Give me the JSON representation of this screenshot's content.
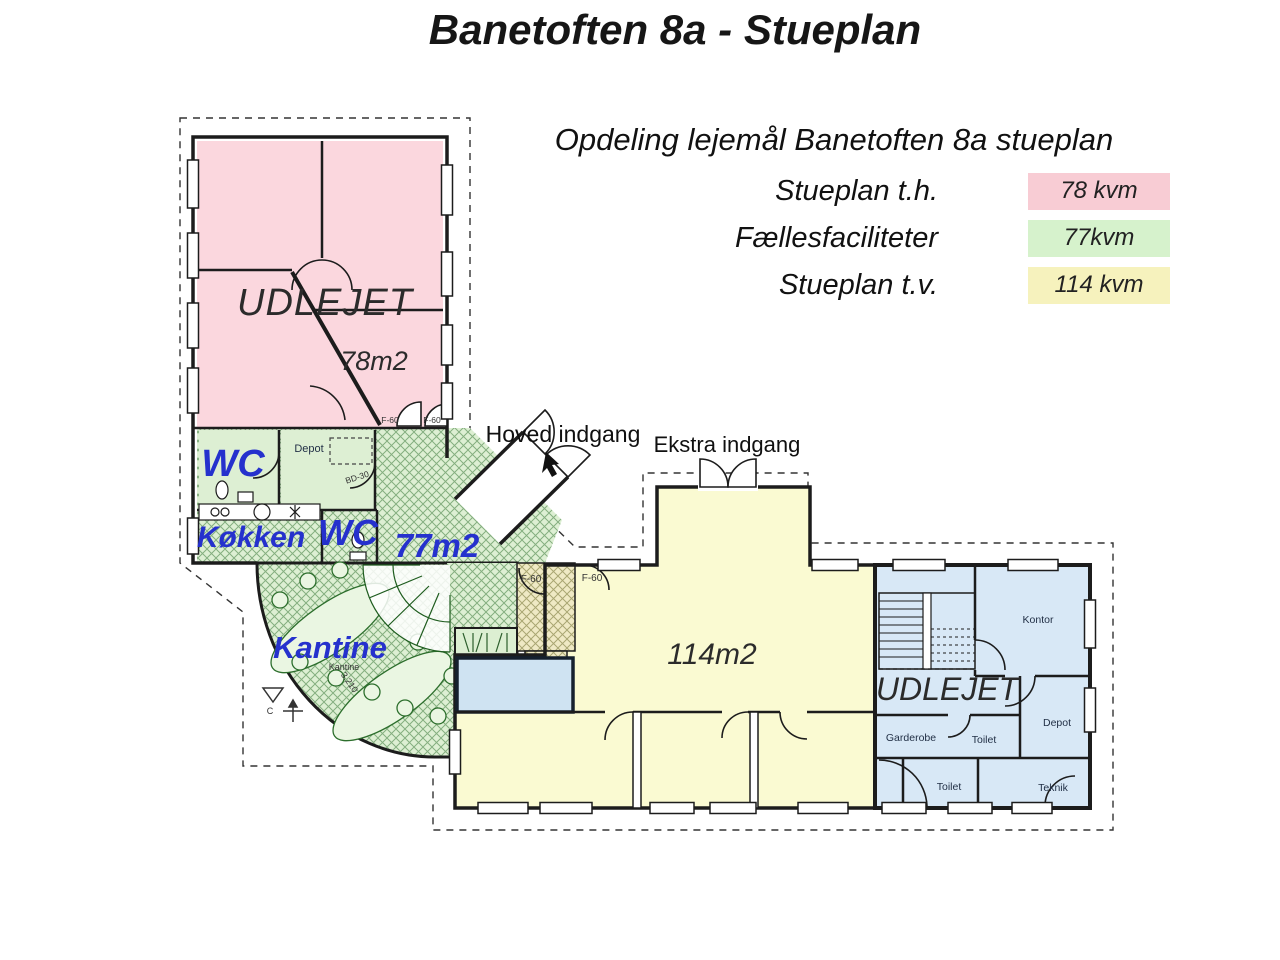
{
  "title": "Banetoften 8a - Stueplan",
  "legend": {
    "heading": "Opdeling lejemål Banetoften 8a stueplan",
    "rows": [
      {
        "label": "Stueplan t.h.",
        "value": "78 kvm",
        "color": "#f8ccd4"
      },
      {
        "label": "Fællesfaciliteter",
        "value": "77kvm",
        "color": "#d6f2cc"
      },
      {
        "label": "Stueplan t.v.",
        "value": "114 kvm",
        "color": "#f6f2bd"
      }
    ]
  },
  "plan": {
    "zones": {
      "left_unit": {
        "status_label": "UDLEJET",
        "area_label": "78m2",
        "color": "#fbd7de"
      },
      "common": {
        "area_label": "77m2",
        "color": "#ddefd3",
        "rooms": {
          "wc_1": "WC",
          "depot": "Depot",
          "kitchen": "Køkken",
          "wc_2": "WC",
          "canteen": "Kantine"
        },
        "small_labels": {
          "canteen": "Kantine",
          "room_number": "3.210",
          "door": "BD-30"
        }
      },
      "right_open": {
        "area_label": "114m2",
        "color": "#fafad2"
      },
      "right_unit": {
        "status_label": "UDLEJET",
        "color": "#d8e8f6",
        "rooms": {
          "kontor": "Kontor",
          "garderobe": "Garderobe",
          "toilet_upper": "Toilet",
          "depot": "Depot",
          "toilet_lower": "Toilet",
          "teknik": "Teknik"
        }
      }
    },
    "entrances": {
      "main": "Hoved indgang",
      "extra": "Ekstra indgang"
    },
    "fire_doors": [
      "F-60",
      "F-60",
      "F-60",
      "F-60"
    ],
    "markers": {
      "compass": "C"
    }
  }
}
